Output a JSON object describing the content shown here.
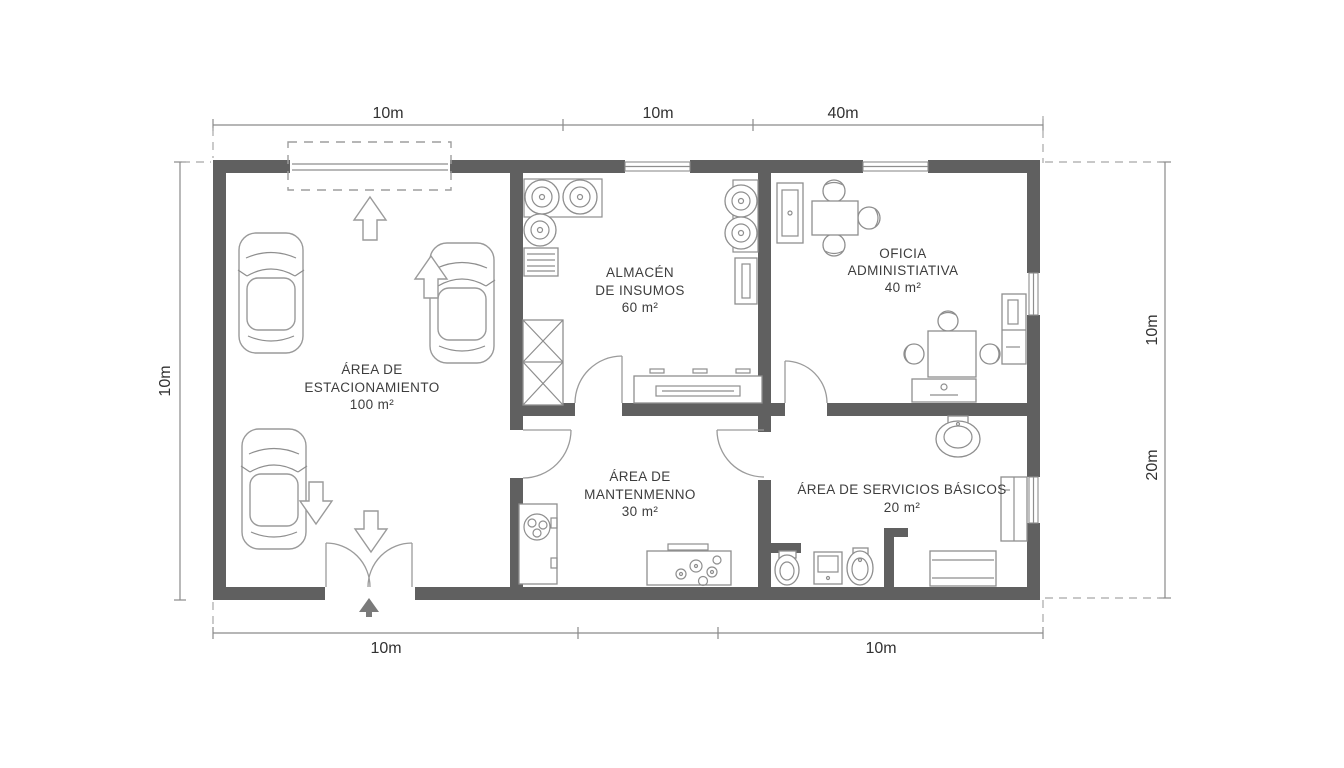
{
  "plan": {
    "type": "floor-plan",
    "rooms": [
      {
        "id": "estacionamiento",
        "lines": [
          "ÁREA DE",
          "ESTACIONAMIENTO",
          "100 m²"
        ]
      },
      {
        "id": "almacen",
        "lines": [
          "ALMACÉN",
          "DE INSUMOS",
          "60 m²"
        ]
      },
      {
        "id": "oficina",
        "lines": [
          "OFICIA",
          "ADMINISTIATIVA",
          "40 m²"
        ]
      },
      {
        "id": "mantenimiento",
        "lines": [
          "ÁREA DE",
          "MANTENMENNO",
          "30 m²"
        ]
      },
      {
        "id": "servicios",
        "lines": [
          "ÁREA DE SERVICIOS BÁSICOS",
          "20 m²"
        ]
      }
    ],
    "dimensions": {
      "top": [
        "10m",
        "10m",
        "40m"
      ],
      "bottom": [
        "10m",
        "10m"
      ],
      "left": [
        "10m"
      ],
      "right": [
        "10m",
        "20m"
      ]
    },
    "colors": {
      "wall": "#606060",
      "furniture_line": "#8e8e8e",
      "car_line": "#9a9a9a",
      "label_text": "#3d3d3d",
      "dimension_text": "#323232",
      "dashed_line": "#9e9e9e",
      "background": "#ffffff"
    }
  }
}
